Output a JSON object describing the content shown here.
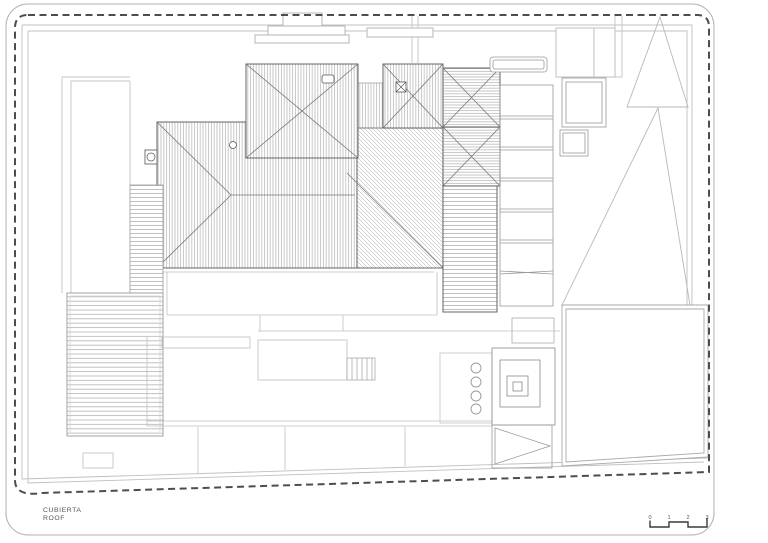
{
  "drawing": {
    "label_primary": "CUBIERTA",
    "label_secondary": "ROOF",
    "sheet_type": "roof-plan"
  },
  "scale_bar": {
    "labels": [
      "0",
      "1",
      "2",
      "3"
    ]
  },
  "palette": {
    "background": "#ffffff",
    "boundary_dash": "#4d4d4d",
    "sheet_border": "#b0b0b0",
    "roof_outline": "#555555",
    "hip_line": "#777777",
    "hatch": "#9b9b9b",
    "light_line": "#bfbfbf",
    "text": "#555555"
  }
}
